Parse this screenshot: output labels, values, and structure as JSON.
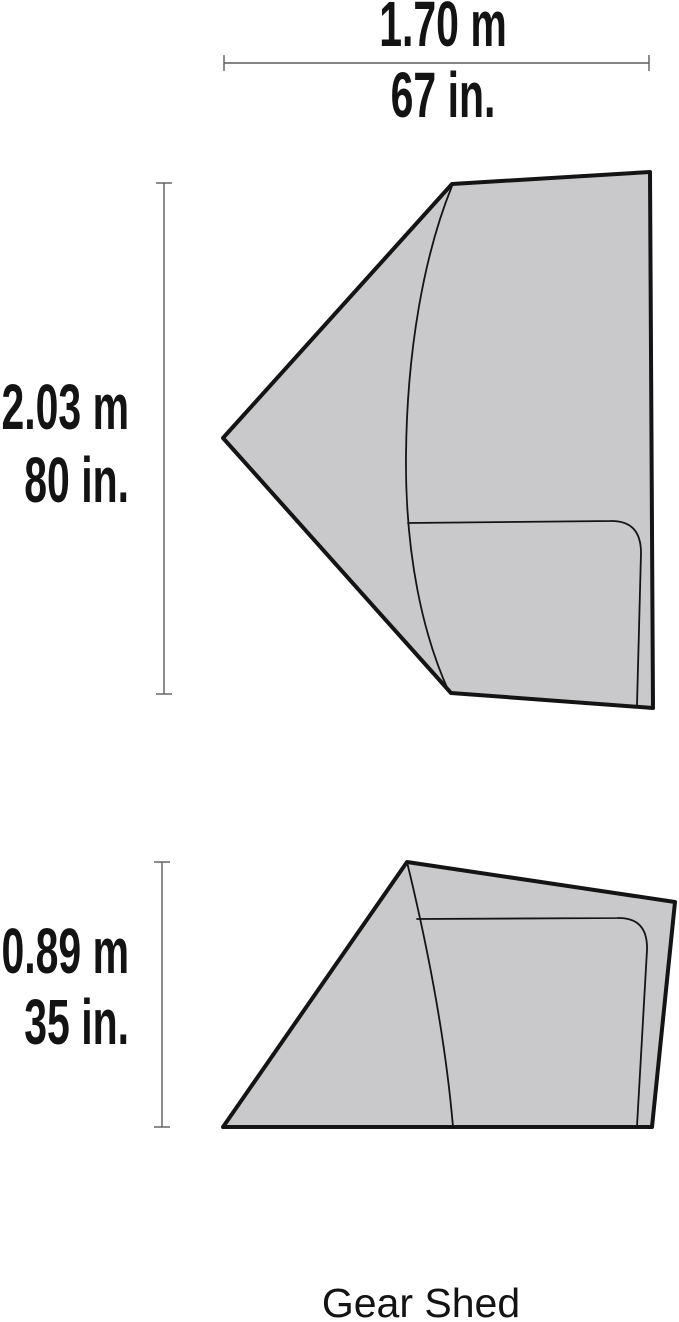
{
  "diagram": {
    "caption": "Gear Shed"
  },
  "dimensions": {
    "width": {
      "metric": "1.70 m",
      "imperial": "67 in."
    },
    "length": {
      "metric": "2.03 m",
      "imperial": "80 in."
    },
    "height": {
      "metric": "0.89 m",
      "imperial": "35 in."
    }
  },
  "colors": {
    "background": "#ffffff",
    "tent_fill": "#c9c9cb",
    "tent_outline": "#141414",
    "dimension_line": "#5c5c5c",
    "label_text": "#131313"
  }
}
